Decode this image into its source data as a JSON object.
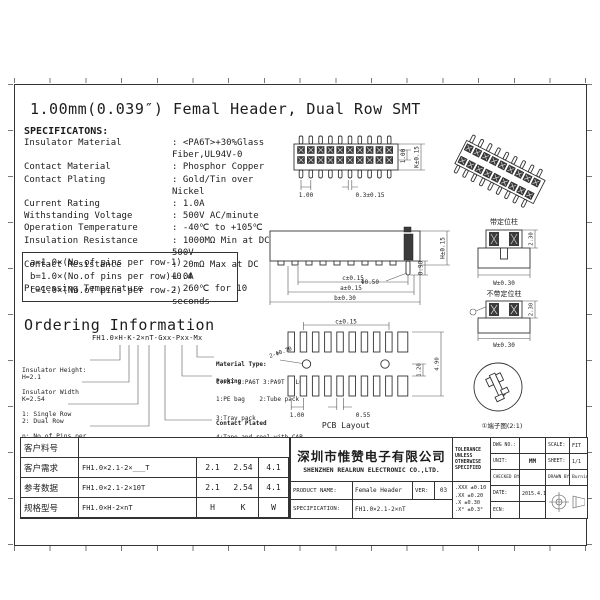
{
  "sheet": {
    "title": "1.00mm(0.039″) Femal Header, Dual Row SMT"
  },
  "specs": {
    "heading": "SPECIFICATONS:",
    "rows": [
      {
        "label": "Insulator Material",
        "value": ": <PA6T>+30%Glass Fiber,UL94V-0"
      },
      {
        "label": "Contact Material",
        "value": ": Phosphor Copper"
      },
      {
        "label": "Contact Plating",
        "value": ": Gold/Tin over Nickel"
      },
      {
        "label": "Current Rating",
        "value": ": 1.0A"
      },
      {
        "label": "Withstanding Voltage",
        "value": ": 500V AC/minute"
      },
      {
        "label": "Operation Temperature",
        "value": ": -40℃ to +105℃"
      },
      {
        "label": "Insulation Resistance",
        "value": ": 1000MΩ Min at DC 500V"
      },
      {
        "label": "Contact Resistance",
        "value": ": 20mΩ Max at DC 1.0A"
      },
      {
        "label": "Processing Temperature",
        "value": ": 260℃ for 10 seconds"
      }
    ]
  },
  "formulas": {
    "lines": [
      "a=1.0×(No.of pins per row-1)",
      "b=1.0×(No.of pins per row)+0.4",
      "c=1.0×(No.of pins per row-2)"
    ]
  },
  "ordering": {
    "heading": "Ordering Information",
    "code": "FH1.0×H-K-2×nT-Gxx-Pxx-Mx",
    "left": [
      {
        "l1": "Insulator Height:",
        "l2": "H=2.1"
      },
      {
        "l1": "Insulator Width",
        "l2": "K=2.54"
      },
      {
        "l1": "1: Single Row",
        "l2": "2: Dual Row"
      },
      {
        "l1": "n: No.of Pins per",
        "l2": "Row",
        "l3": "T: SMT"
      }
    ],
    "right": [
      {
        "title": "Material Type:",
        "line1": "1:PBT 2:PA6T 3:PA9T 4:LCP"
      },
      {
        "title": "Packing",
        "line1": "1:PE bag    2:Tube pack",
        "line2": "3:Tray pack",
        "line3": "4:Tape and reel with CAP",
        "line4": "5:Tape and reel with MYLAR",
        "line5": "6:Tape and reel with KAPTON"
      },
      {
        "title": "Contact Plated",
        "line1": "0:Tin        1:Gold flash",
        "line2": "2:Gold 15u″  3:Gold 1.0u″",
        "line3": "4:Gold 30u″  5:Gold 100u″"
      }
    ]
  },
  "views": {
    "top": {
      "pitch": "1.00",
      "pad": "0.3±0.15",
      "row": "1.00",
      "width": "K±0.15"
    },
    "front": {
      "pin_dia": "Φ0.50",
      "pin_len": "0.90",
      "height": "H±0.15",
      "c": "c±0.15",
      "a": "a±0.15",
      "b": "b±0.30"
    },
    "side1": {
      "title": "带定位柱",
      "h": "2.30",
      "w": "W±0.30"
    },
    "side2": {
      "title": "不带定位柱",
      "h": "2.30",
      "w": "W±0.30"
    },
    "pcb": {
      "caption": "PCB Layout",
      "c": "c±0.15",
      "holes": "2-Φ0.70",
      "pitch": "1.00",
      "pad": "0.55",
      "inner": "1.20",
      "outer": "4.90"
    },
    "detail": {
      "caption": "①端子图(2:1)"
    }
  },
  "titleblock": {
    "left_rows": [
      {
        "label": "客户料号",
        "code": "",
        "h": "",
        "k": "",
        "w": ""
      },
      {
        "label": "客户需求",
        "code": "FH1.0×2.1-2×___T",
        "h": "2.1",
        "k": "2.54",
        "w": "4.1"
      },
      {
        "label": "参考数据",
        "code": "FH1.0×2.1-2×10T",
        "h": "2.1",
        "k": "2.54",
        "w": "4.1"
      },
      {
        "label": "规格型号",
        "code": "FH1.0×H-2×nT",
        "h": "H",
        "k": "K",
        "w": "W"
      }
    ],
    "company_cn": "深圳市惟赞电子有限公司",
    "company_en": "SHENZHEN REALRUN ELECTRONIC CO.,LTD.",
    "product_label": "PRODUCT NAME:",
    "product": "Female Header",
    "ver_label": "VER:",
    "ver": "03",
    "spec_label": "SPECIFICATION:",
    "spec": "FH1.0×2.1-2×nT",
    "tol_title": "TOLERANCE UNLESS OTHERWISE SPECIFIED",
    "tol_lines": [
      ".XXX ±0.10",
      ".XX  ±0.20",
      ".X   ±0.30",
      ".X°  ±0.3°"
    ],
    "dwg_label": "DWG NO.:",
    "dwg": "",
    "unit_label": "UNIT:",
    "unit": "MM",
    "checked_label": "CHECKED BY:",
    "checked": "",
    "date_label": "DATE:",
    "date": "2015.4.12",
    "ecn_label": "ECN:",
    "ecn": "",
    "scale_label": "SCALE:",
    "scale": "FIT",
    "sheet_label": "SHEET:",
    "sheet": "1/1",
    "drawn_label": "DRAWN BY:",
    "drawn": "Burning"
  }
}
